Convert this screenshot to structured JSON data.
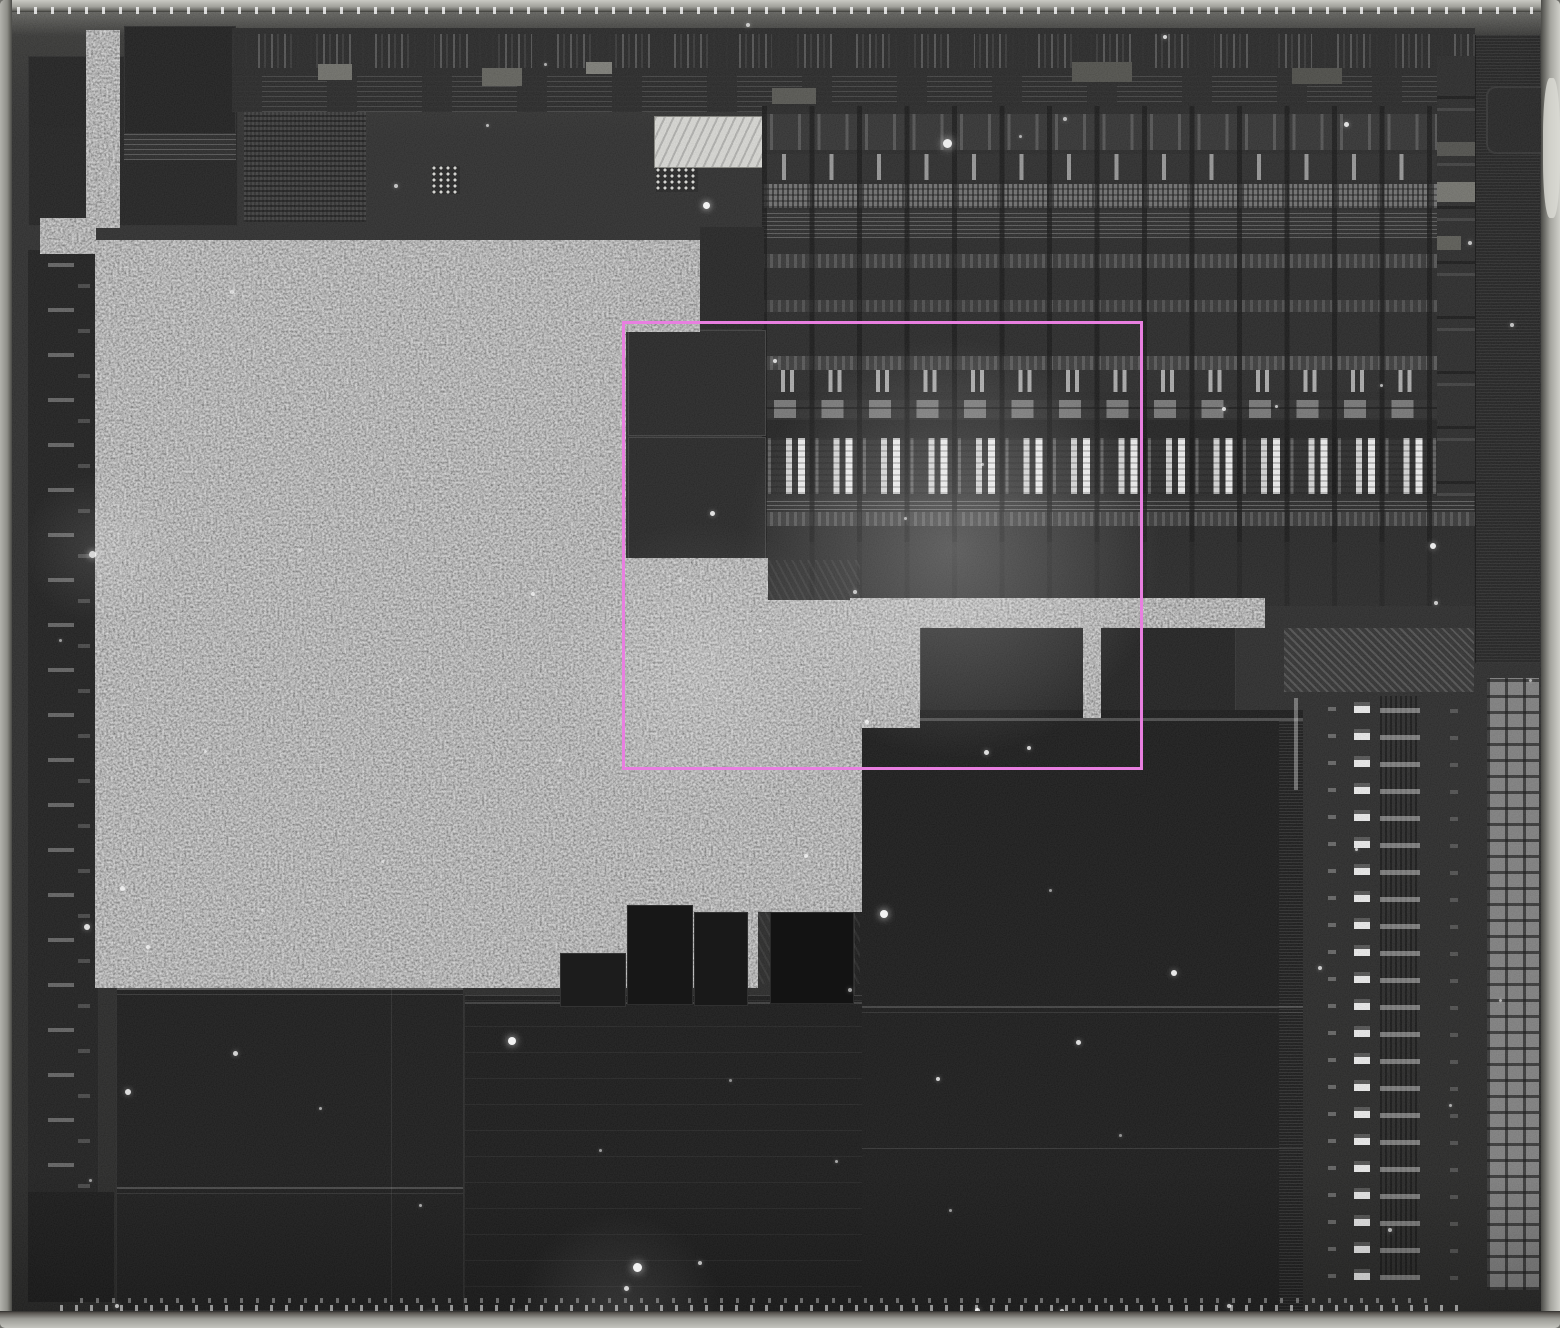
{
  "figure": {
    "type": "integrated-circuit die photograph",
    "style": "grayscale reflected-light micrograph, no visible text",
    "roi_annotation": {
      "shape": "rectangle",
      "x": 622,
      "y": 321,
      "width": 521,
      "height": 449,
      "stroke_width": 3
    }
  },
  "colors": {
    "die_edge": "#a8a8a2",
    "substrate": "#242424",
    "dark_block": "#141414",
    "texture_gray": "#6e6e6e",
    "array_highlight": "#f2f2f2",
    "annotation": "#e87fe0",
    "speckle": "#ffffff"
  },
  "speckles": [
    [
      706,
      205,
      7,
      0.95
    ],
    [
      947,
      143,
      9,
      0.9
    ],
    [
      1165,
      37,
      4,
      0.8
    ],
    [
      1346,
      124,
      5,
      0.85
    ],
    [
      1470,
      243,
      4,
      0.7
    ],
    [
      1224,
      409,
      4,
      0.8
    ],
    [
      1276,
      406,
      3,
      0.7
    ],
    [
      1381,
      385,
      3,
      0.65
    ],
    [
      1433,
      546,
      6,
      0.9
    ],
    [
      775,
      361,
      4,
      0.8
    ],
    [
      712,
      513,
      5,
      0.85
    ],
    [
      533,
      594,
      4,
      0.7
    ],
    [
      867,
      722,
      4,
      0.75
    ],
    [
      986,
      752,
      5,
      0.85
    ],
    [
      1029,
      748,
      4,
      0.8
    ],
    [
      806,
      856,
      4,
      0.7
    ],
    [
      884,
      914,
      8,
      0.95
    ],
    [
      1078,
      1042,
      5,
      0.85
    ],
    [
      938,
      1079,
      4,
      0.8
    ],
    [
      1174,
      973,
      6,
      0.9
    ],
    [
      1320,
      968,
      4,
      0.75
    ],
    [
      1356,
      849,
      3,
      0.7
    ],
    [
      626,
      1288,
      5,
      0.8
    ],
    [
      637,
      1267,
      9,
      0.95
    ],
    [
      520,
      1313,
      4,
      0.7
    ],
    [
      1062,
      1311,
      4,
      0.75
    ],
    [
      235,
      1053,
      5,
      0.8
    ],
    [
      128,
      1092,
      6,
      0.85
    ],
    [
      148,
      947,
      4,
      0.7
    ],
    [
      87,
      927,
      6,
      0.85
    ],
    [
      320,
      1108,
      3,
      0.6
    ],
    [
      420,
      1205,
      3,
      0.6
    ],
    [
      700,
      1263,
      4,
      0.7
    ],
    [
      600,
      1150,
      3,
      0.55
    ],
    [
      512,
      1041,
      8,
      0.95
    ],
    [
      836,
      1161,
      3,
      0.6
    ],
    [
      1436,
      603,
      4,
      0.75
    ],
    [
      1512,
      325,
      4,
      0.7
    ],
    [
      92,
      554,
      7,
      0.8
    ],
    [
      122,
      888,
      5,
      0.75
    ],
    [
      232,
      292,
      4,
      0.6
    ],
    [
      396,
      186,
      4,
      0.7
    ],
    [
      487,
      125,
      3,
      0.65
    ],
    [
      545,
      64,
      3,
      0.6
    ],
    [
      748,
      25,
      4,
      0.7
    ],
    [
      1020,
      136,
      3,
      0.6
    ],
    [
      1065,
      119,
      4,
      0.65
    ],
    [
      855,
      592,
      4,
      0.7
    ],
    [
      905,
      518,
      3,
      0.6
    ],
    [
      982,
      464,
      3,
      0.6
    ],
    [
      760,
      630,
      3,
      0.55
    ],
    [
      680,
      580,
      3,
      0.5
    ],
    [
      560,
      760,
      3,
      0.5
    ],
    [
      400,
      680,
      3,
      0.5
    ],
    [
      300,
      550,
      3,
      0.5
    ],
    [
      205,
      751,
      3,
      0.5
    ],
    [
      262,
      910,
      3,
      0.5
    ],
    [
      382,
      861,
      3,
      0.5
    ],
    [
      1500,
      1000,
      3,
      0.6
    ],
    [
      1450,
      1105,
      3,
      0.6
    ],
    [
      1390,
      1230,
      4,
      0.65
    ],
    [
      90,
      1180,
      3,
      0.55
    ],
    [
      60,
      640,
      3,
      0.55
    ],
    [
      1530,
      680,
      3,
      0.6
    ],
    [
      1050,
      890,
      3,
      0.55
    ],
    [
      950,
      1210,
      3,
      0.55
    ],
    [
      1120,
      1135,
      3,
      0.5
    ],
    [
      730,
      1080,
      3,
      0.5
    ],
    [
      850,
      990,
      4,
      0.6
    ],
    [
      977,
      1310,
      5,
      0.8
    ],
    [
      430,
      1313,
      4,
      0.7
    ],
    [
      117,
      1306,
      4,
      0.7
    ],
    [
      1229,
      1306,
      4,
      0.7
    ]
  ]
}
